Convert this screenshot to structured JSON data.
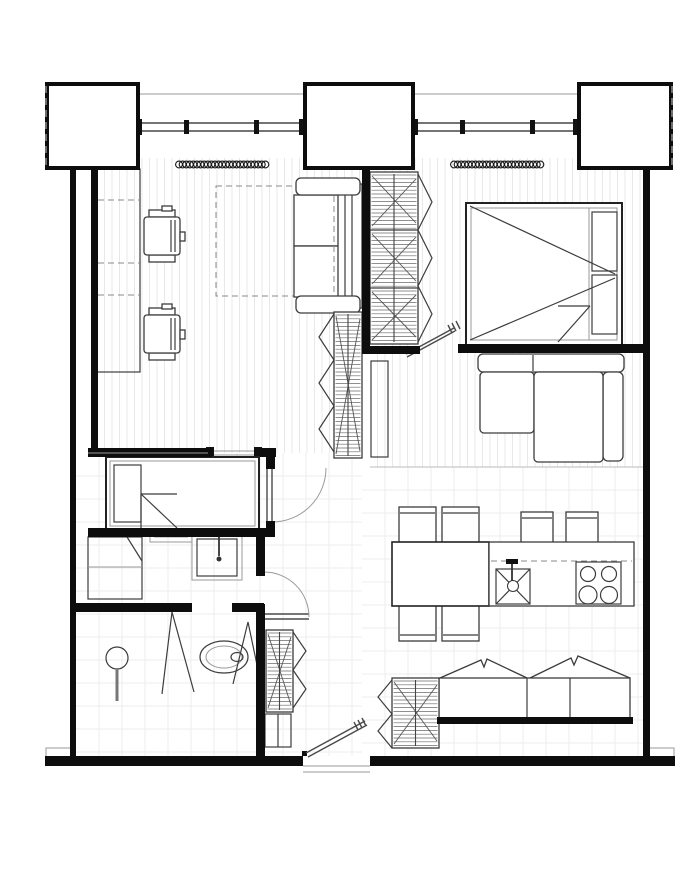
{
  "document": {
    "kind": "floor-plan",
    "style": "black-and-white architectural line drawing",
    "orientation": "top-down"
  },
  "palette": {
    "background": "#ffffff",
    "wall": "#0d0d0d",
    "furniture_line": "#3c3c3c",
    "thin_line": "#9a9a9a",
    "wood_stripe": "#e8e8e8",
    "tile_line": "#ededed",
    "door_arc": "#999999",
    "dash": "#8a8a8a"
  },
  "structure": {
    "pillars": 3,
    "windows": 2,
    "window_mullions_per_window": 4,
    "radiators": 2,
    "entry_doors": 1,
    "interior_doors": 3
  },
  "rooms": [
    {
      "id": "living-room",
      "area": "top-left",
      "furniture": [
        "built-in-desk",
        "office-chair",
        "office-chair",
        "rug",
        "two-seat-sofa",
        "wardrobe",
        "tv-unit",
        "radiator"
      ]
    },
    {
      "id": "bedroom",
      "area": "top-right",
      "furniture": [
        "double-bed",
        "wardrobe",
        "corner-sofa",
        "radiator"
      ]
    },
    {
      "id": "kids-room",
      "area": "mid-left",
      "furniture": [
        "single-bed"
      ]
    },
    {
      "id": "bathroom",
      "area": "left",
      "furniture": [
        "washing-machine",
        "shelf",
        "washbasin"
      ]
    },
    {
      "id": "shower-wc",
      "area": "bottom-left",
      "furniture": [
        "shower",
        "toilet"
      ]
    },
    {
      "id": "hallway",
      "area": "center",
      "furniture": [
        "wardrobe",
        "cabinet"
      ]
    },
    {
      "id": "kitchen-dining",
      "area": "bottom-right",
      "furniture": [
        "dining-table",
        "chair",
        "chair",
        "chair",
        "chair",
        "kitchen-counter",
        "sink",
        "cooktop-4-burners",
        "bar-stool",
        "bar-stool",
        "bench-sofa",
        "wardrobe"
      ]
    }
  ]
}
